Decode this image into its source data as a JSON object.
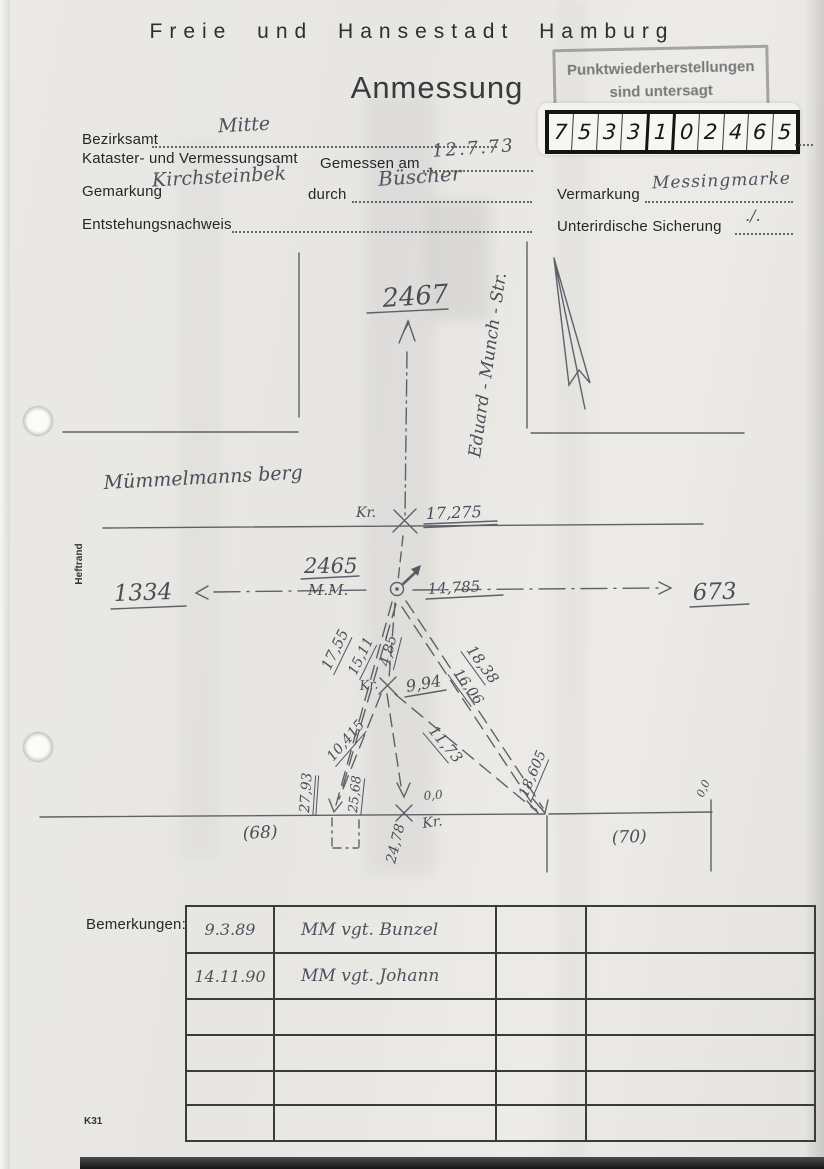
{
  "page": {
    "header": "Freie und Hansestadt Hamburg",
    "title": "Anmessung",
    "form_code": "K31"
  },
  "stamp": {
    "line1": "Punktwiederherstellungen",
    "line2": "sind untersagt"
  },
  "point_number": {
    "digits": [
      "7",
      "5",
      "3",
      "3",
      "1",
      "0",
      "2",
      "4",
      "6",
      "5"
    ]
  },
  "fields": {
    "bezirksamt_label": "Bezirksamt",
    "bezirksamt_value": "Mitte",
    "kataster_label": "Kataster- und Vermessungsamt",
    "gemessen_label": "Gemessen am",
    "gemessen_value": "12.7.73",
    "gemarkung_label": "Gemarkung",
    "gemarkung_value": "Kirchsteinbek",
    "durch_label": "durch",
    "durch_value": "Büscher",
    "vermarkung_label": "Vermarkung",
    "vermarkung_value": "Messingmarke",
    "entstehung_label": "Entstehungsnachweis",
    "sicherung_label": "Unterirdische Sicherung",
    "sicherung_value": "./."
  },
  "margin_label": "Heftrand",
  "sketch": {
    "street_vertical": "Eduard - Munch - Str.",
    "area_name": "Mümmelmanns berg",
    "point_north": "2467",
    "point_center": "2465",
    "point_center_sub": "M.M.",
    "point_west": "1334",
    "point_east": "673",
    "kr": "Kr.",
    "zero": "0,0",
    "m_17275": "17,275",
    "m_14785": "14,785",
    "m_1755": "17,55",
    "m_1511": "15,11",
    "m_485": "4,85",
    "m_1838": "18,38",
    "m_1606": "16,06",
    "m_994": "9,94",
    "m_10415": "10,415",
    "m_1173": "11,73",
    "m_18605": "18,605",
    "m_2793": "27,93",
    "m_2568": "25,68",
    "m_2478": "24,78",
    "parcel_left": "(68)",
    "parcel_right": "(70)"
  },
  "bemerkungen": {
    "label": "Bemerkungen:",
    "rows": [
      {
        "date": "9.3.89",
        "text": "MM vgt. Bunzel"
      },
      {
        "date": "14.11.90",
        "text": "MM vgt. Johann"
      },
      {
        "date": "",
        "text": ""
      },
      {
        "date": "",
        "text": ""
      },
      {
        "date": "",
        "text": ""
      },
      {
        "date": "",
        "text": ""
      }
    ]
  }
}
